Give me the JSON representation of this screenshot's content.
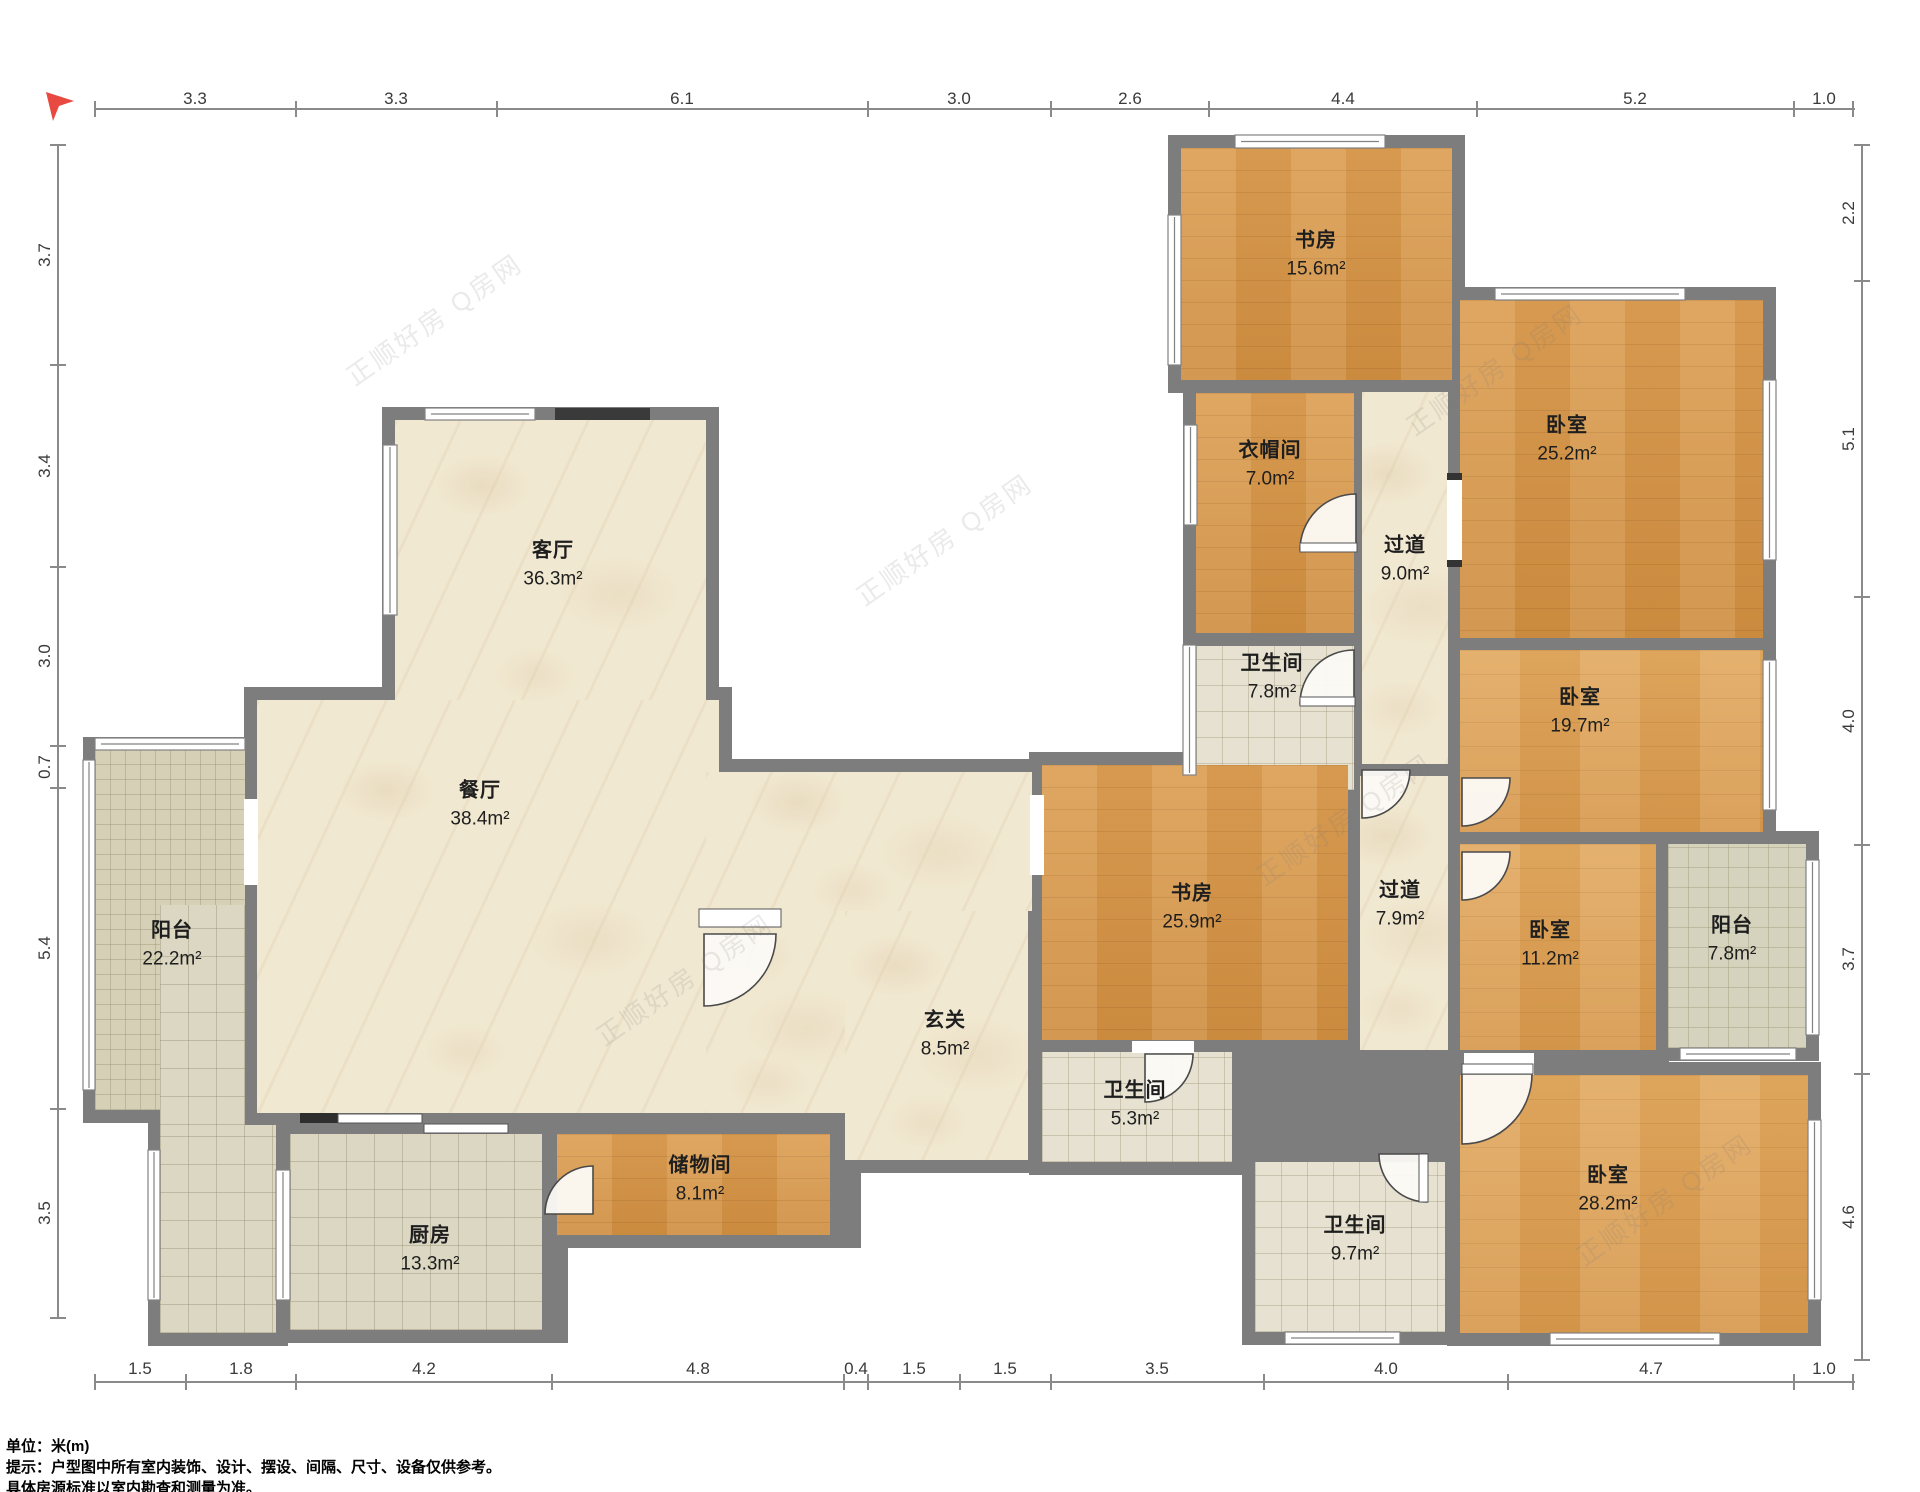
{
  "watermark": {
    "text": "正顺好房 Q房网"
  },
  "notes": {
    "line1": "单位：米(m)",
    "line2": "提示：户型图中所有室内装饰、设计、摆设、间隔、尺寸、设备仅供参考。",
    "line3": "具体房源标准以室内勘查和测量为准。"
  },
  "dimensions": {
    "top": [
      "3.3",
      "3.3",
      "6.1",
      "3.0",
      "2.6",
      "4.4",
      "5.2",
      "1.0"
    ],
    "left": [
      "3.7",
      "3.4",
      "3.0",
      "0.7",
      "5.4",
      "3.5"
    ],
    "right": [
      "2.2",
      "5.1",
      "4.0",
      "3.7",
      "4.6"
    ],
    "bottom": [
      "1.5",
      "1.8",
      "4.2",
      "4.8",
      "0.4",
      "1.5",
      "1.5",
      "3.5",
      "4.0",
      "4.7",
      "1.0"
    ]
  },
  "rooms": [
    {
      "name": "书房",
      "area": "15.6m²"
    },
    {
      "name": "卧室",
      "area": "25.2m²"
    },
    {
      "name": "衣帽间",
      "area": "7.0m²"
    },
    {
      "name": "过道",
      "area": "9.0m²"
    },
    {
      "name": "卫生间",
      "area": "7.8m²"
    },
    {
      "name": "卧室",
      "area": "19.7m²"
    },
    {
      "name": "客厅",
      "area": "36.3m²"
    },
    {
      "name": "餐厅",
      "area": "38.4m²"
    },
    {
      "name": "玄关",
      "area": "8.5m²"
    },
    {
      "name": "阳台",
      "area": "22.2m²"
    },
    {
      "name": "书房",
      "area": "25.9m²"
    },
    {
      "name": "过道",
      "area": "7.9m²"
    },
    {
      "name": "卧室",
      "area": "11.2m²"
    },
    {
      "name": "阳台",
      "area": "7.8m²"
    },
    {
      "name": "卫生间",
      "area": "5.3m²"
    },
    {
      "name": "储物间",
      "area": "8.1m²"
    },
    {
      "name": "厨房",
      "area": "13.3m²"
    },
    {
      "name": "卫生间",
      "area": "9.7m²"
    },
    {
      "name": "卧室",
      "area": "28.2m²"
    }
  ]
}
